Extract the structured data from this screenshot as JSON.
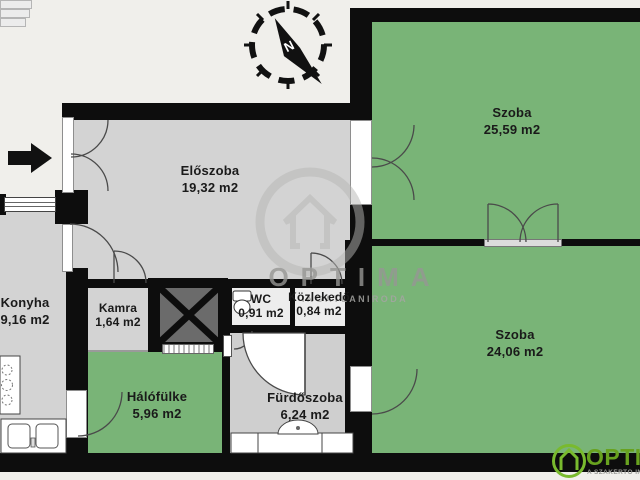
{
  "rooms": {
    "eloszoba": {
      "name": "Előszoba",
      "area": "19,32 m2"
    },
    "szoba1": {
      "name": "Szoba",
      "area": "25,59 m2"
    },
    "szoba2": {
      "name": "Szoba",
      "area": "24,06 m2"
    },
    "konyha": {
      "name": "Konyha",
      "area": "9,16 m2"
    },
    "kamra": {
      "name": "Kamra",
      "area": "1,64 m2"
    },
    "wc": {
      "name": "WC",
      "area": "0,91 m2"
    },
    "kozlekedo": {
      "name": "Közlekedő",
      "area": "0,84 m2"
    },
    "halofulke": {
      "name": "Hálófülke",
      "area": "5,96 m2"
    },
    "furdoszoba": {
      "name": "Fürdőszoba",
      "area": "6,24 m2"
    }
  },
  "compass": {
    "north_label": "N"
  },
  "watermark": {
    "brand": "OPTIMA",
    "tagline": "INGATLANIRODA"
  },
  "logo": {
    "brand": "OPTIMA",
    "tagline": "A SZAKÉRTŐ INGATLANIRODA"
  },
  "colors": {
    "background": "#f0efeb",
    "wall": "#0d0d0d",
    "room_gray": "#d3d3d3",
    "room_green": "#79b477",
    "shaft_gray": "#6b6b6b",
    "logo_green": "#76b82a"
  }
}
